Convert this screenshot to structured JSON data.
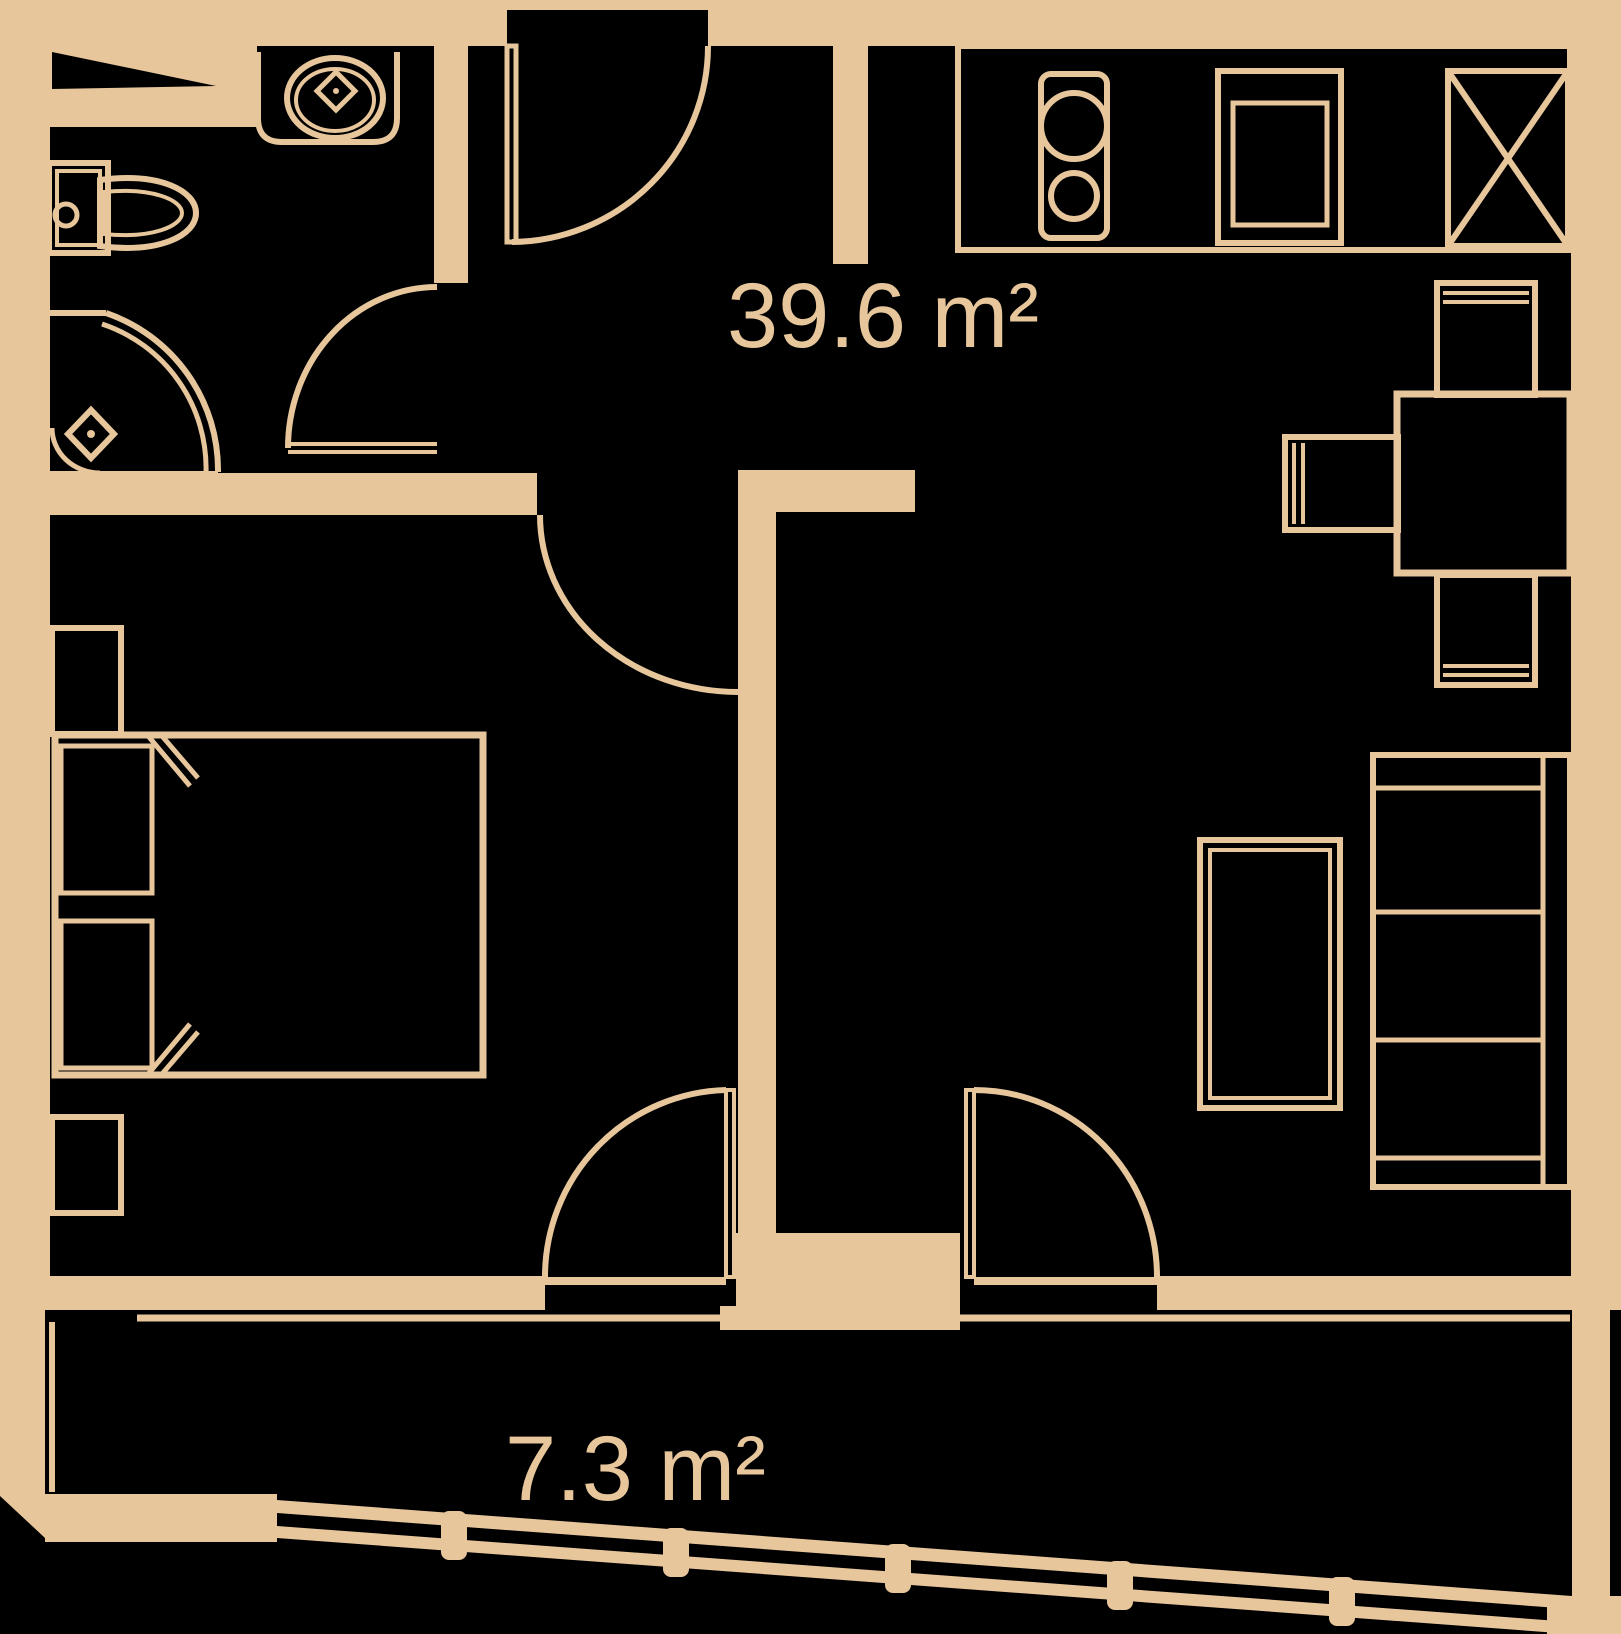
{
  "plan": {
    "type": "apartment-floor-plan",
    "labels": {
      "living_area": "39.6 m²",
      "balcony_area": "7.3 m²"
    },
    "colors": {
      "background": "#000000",
      "line": "#e7c69b"
    },
    "fixtures": [
      "entrance-door",
      "bathroom-sink",
      "toilet",
      "corner-shower",
      "bathroom-door",
      "bedroom-door",
      "double-bed",
      "nightstand",
      "kitchen-counter",
      "stove",
      "kitchen-sink",
      "appliance-x-box",
      "dining-table",
      "chair",
      "sofa",
      "coffee-table",
      "balcony-door",
      "balcony-railing"
    ]
  }
}
